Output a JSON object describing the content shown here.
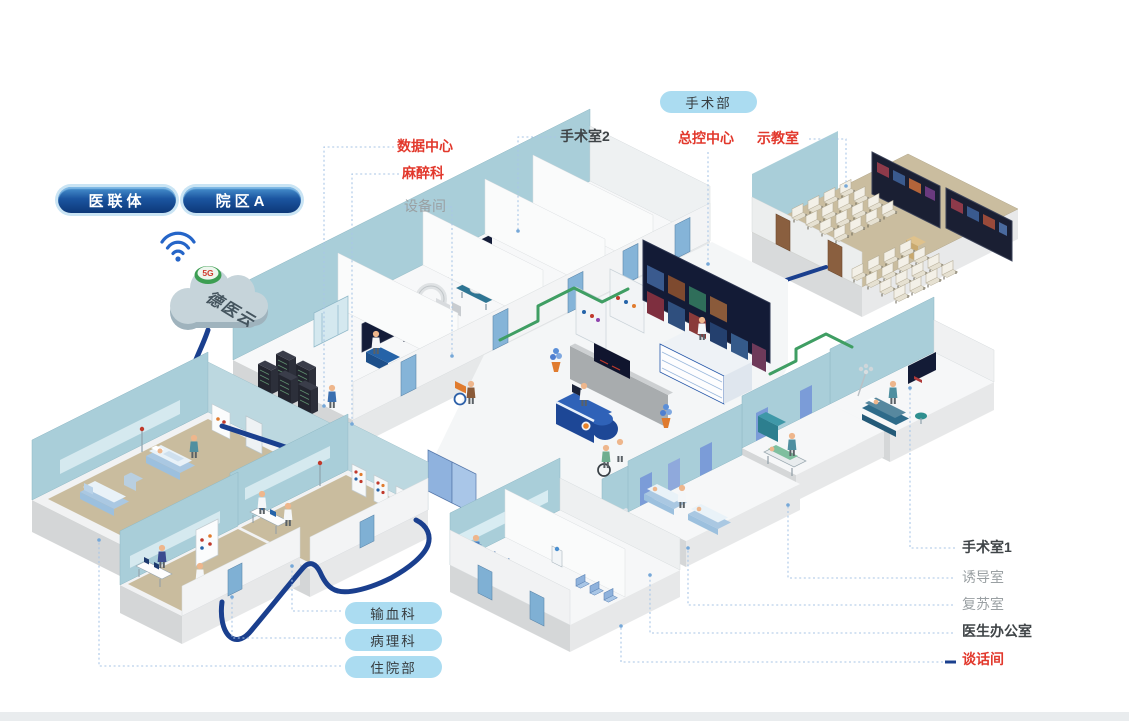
{
  "header_pills": {
    "medical_alliance": "医联体",
    "campus_a": "院区A"
  },
  "cloud": {
    "name": "德医云",
    "badge": "5G",
    "wifi_icon": "wifi-icon"
  },
  "surgery_department": {
    "pill": "手术部"
  },
  "top_labels": {
    "or_room_2": {
      "text": "手术室2",
      "color": "#3f4447"
    },
    "master_control": {
      "text": "总控中心",
      "color": "#e2382c"
    },
    "demo_room": {
      "text": "示教室",
      "color": "#e2382c"
    }
  },
  "left_labels": {
    "data_center": {
      "text": "数据中心",
      "color": "#e2382c"
    },
    "anesthesiology": {
      "text": "麻醉科",
      "color": "#e2382c"
    },
    "equipment_room": {
      "text": "设备间",
      "color": "#9aa0a3"
    }
  },
  "right_labels": {
    "or_room_1": {
      "text": "手术室1",
      "color": "#3f4447"
    },
    "induction_room": {
      "text": "诱导室",
      "color": "#9aa0a3"
    },
    "recovery_room": {
      "text": "复苏室",
      "color": "#9aa0a3"
    },
    "doctor_office": {
      "text": "医生办公室",
      "color": "#3f4447"
    },
    "talk_room": {
      "text": "谈话间",
      "color": "#e2382c"
    }
  },
  "bottom_pills": {
    "blood_transfusion": "输血科",
    "pathology": "病理科",
    "inpatient": "住院部"
  },
  "wall_marks": {
    "or2": "OR2",
    "or3": "OR3"
  },
  "colors": {
    "label_red": "#e2382c",
    "label_dark": "#3f4447",
    "label_gray": "#9aa0a3",
    "pill_light_bg": "#abdcf1",
    "pill_dark_bg": "#16498e",
    "cable_blue": "#1a3f8e",
    "cable_green": "#3f9e63",
    "wall_teal": "#a9ced9",
    "floor_tan": "#c9bc9e",
    "leader_blue": "#a9c6e6"
  }
}
